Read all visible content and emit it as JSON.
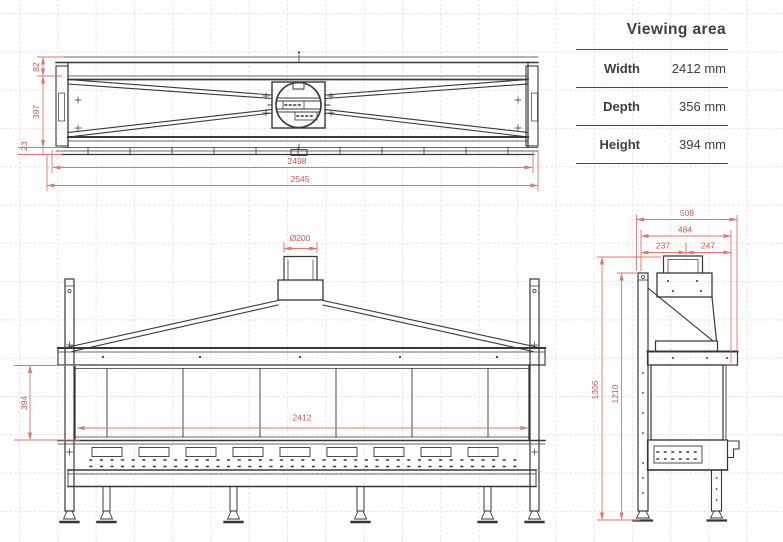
{
  "table": {
    "title": "Viewing area",
    "rows": [
      {
        "label": "Width",
        "value": "2412 mm"
      },
      {
        "label": "Depth",
        "value": "356 mm"
      },
      {
        "label": "Height",
        "value": "394 mm"
      }
    ]
  },
  "dims": {
    "top": {
      "rear_depth": "82",
      "body_depth": "397",
      "front_lip": "23",
      "inner_width": "2498",
      "overall_width": "2545"
    },
    "front": {
      "flue_diameter": "Ø200",
      "glass_height": "394",
      "glass_width": "2412"
    },
    "side": {
      "overall_depth": "508",
      "frame_depth": "484",
      "rear_to_flue_center": "237",
      "flue_center_to_front": "247",
      "overall_height": "1306",
      "frame_height": "1210"
    }
  },
  "colors": {
    "dimension_red": "#dd6a5f",
    "drawing_line": "#3d3d3d",
    "grid_pink": "#f1dede",
    "table_text": "#3f3f3f"
  }
}
